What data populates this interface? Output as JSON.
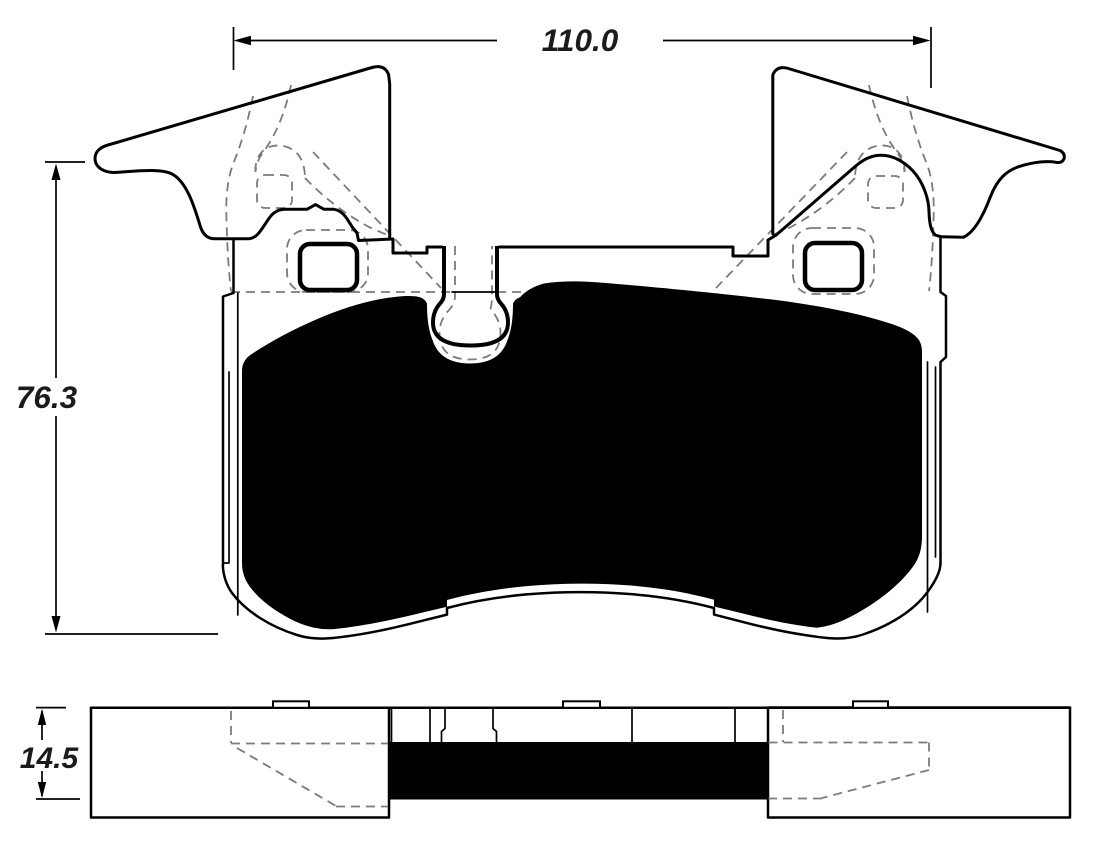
{
  "front_view": {
    "width_dim_label": "110.0",
    "height_dim_label": "76.3"
  },
  "side_view": {
    "thickness_dim_label": "14.5"
  },
  "colors": {
    "background": "#ffffff",
    "line": "#000000",
    "friction_fill": "#000000",
    "hidden_edge_dash": "#7b7b7b",
    "dimension_text": "#1b1b1b"
  }
}
